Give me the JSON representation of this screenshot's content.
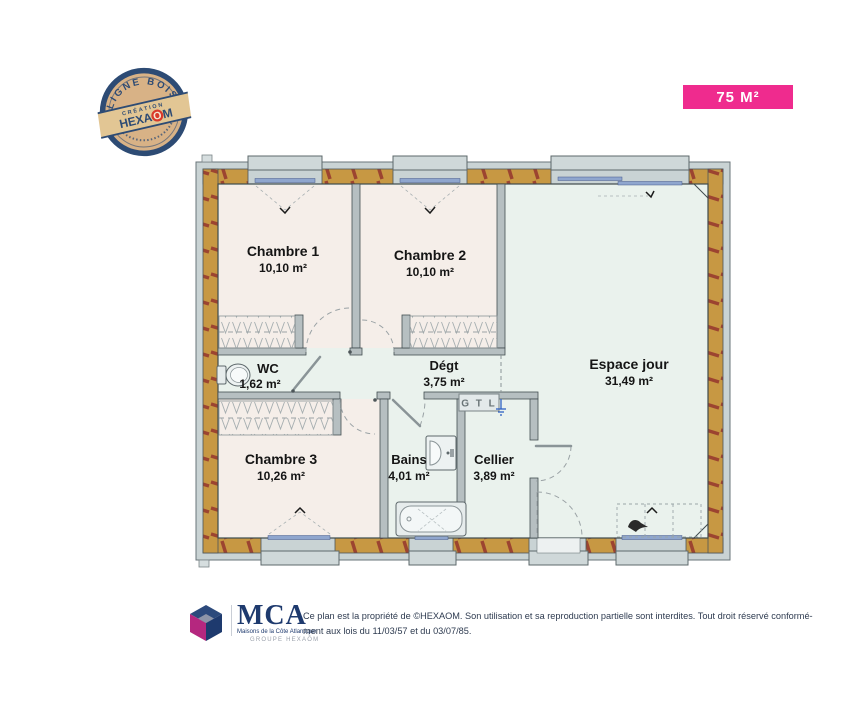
{
  "badge": {
    "label": "75 M²"
  },
  "stamp": {
    "arc_top": "LIGNE BOIS",
    "banner_top": "CRÉATION",
    "brand_prefix": "HEXA",
    "brand_o": "O",
    "brand_suffix": "M"
  },
  "plan": {
    "rooms": [
      {
        "name": "Chambre 1",
        "area": "10,10 m²"
      },
      {
        "name": "Chambre 2",
        "area": "10,10 m²"
      },
      {
        "name": "Espace jour",
        "area": "31,49 m²"
      },
      {
        "name": "WC",
        "area": "1,62 m²"
      },
      {
        "name": "Dégt",
        "area": "3,75 m²"
      },
      {
        "name": "Chambre 3",
        "area": "10,26 m²"
      },
      {
        "name": "Bains",
        "area": "4,01 m²"
      },
      {
        "name": "Cellier",
        "area": "3,89 m²"
      }
    ],
    "labels": {
      "gtl": "G T L"
    }
  },
  "footer": {
    "brand": "MCA",
    "brand_subtitle": "Maisons de la Côte Atlantique",
    "brand_group": "GROUPE HEXAŌM",
    "disclaimer_line1": "Ce plan est la propriété de ©HEXAOM. Son utilisation et sa reproduction partielle sont interdites. Tout droit réservé conformé-",
    "disclaimer_line2": "ment aux lois du 11/03/57 et du 03/07/85."
  },
  "colors": {
    "badge_pink": "#EF2B8E",
    "stamp_navy": "#2D4B74",
    "stamp_red": "#D93A2B",
    "wall_wood": "#C79843",
    "wall_tie_red": "#9C4430",
    "floor_bedroom": "#F5EEE9",
    "floor_living": "#EAF2ED",
    "window_blue": "#8FA6CE",
    "mca_navy": "#1E3A6E",
    "mca_magenta": "#B5277F"
  }
}
